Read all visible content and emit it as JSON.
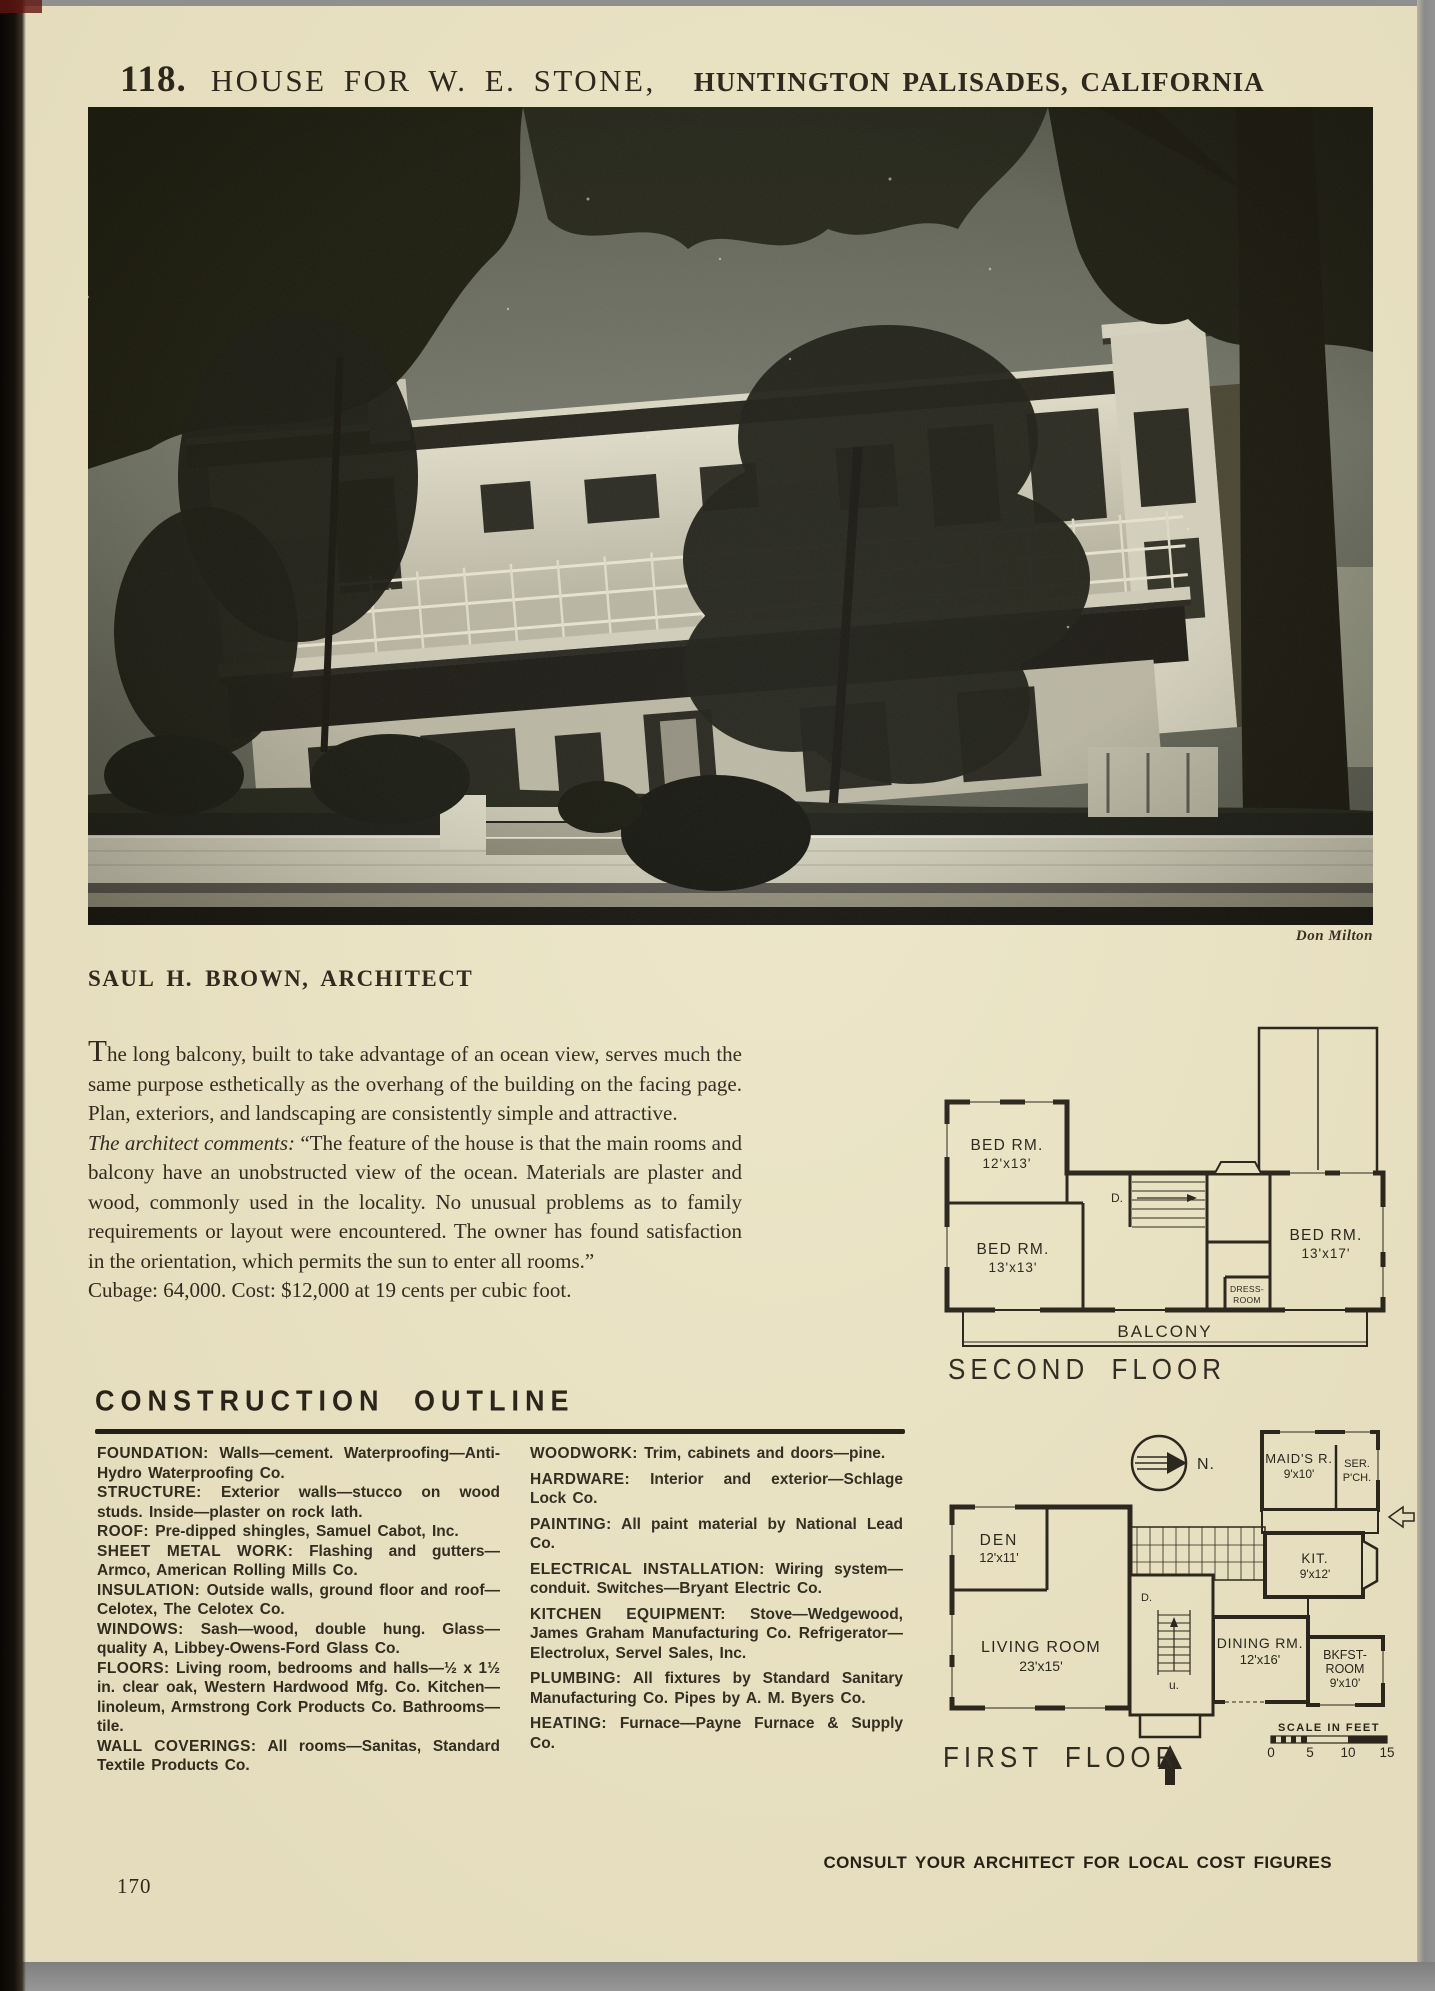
{
  "page": {
    "plate_number": "118.",
    "title": "HOUSE FOR W. E. STONE,",
    "location": "HUNTINGTON PALISADES, CALIFORNIA",
    "photo_credit": "Don Milton",
    "architect": "SAUL H. BROWN, ARCHITECT",
    "footer": "CONSULT YOUR ARCHITECT FOR LOCAL COST FIGURES",
    "page_number": "170"
  },
  "intro": {
    "p1": "The long balcony, built to take advantage of an ocean view, serves much the same purpose esthetically as the overhang of the building on the facing page. Plan, exteriors, and landscaping are consistently simple and attractive.",
    "p2_lead": "The architect comments:",
    "p2": "“The feature of the house is that the main rooms and balcony have an unobstructed view of the ocean. Materials are plaster and wood, commonly used in the locality. No unusual problems as to family requirements or layout were encountered. The owner has found satisfaction in the orientation, which permits the sun to enter all rooms.”",
    "p3": "Cubage: 64,000. Cost: $12,000 at 19 cents per cubic foot."
  },
  "construction_outline": {
    "heading": "CONSTRUCTION OUTLINE",
    "left_column": [
      {
        "label": "FOUNDATION:",
        "text": "Walls—cement. Waterproofing—Anti-Hydro Waterproofing Co."
      },
      {
        "label": "STRUCTURE:",
        "text": "Exterior walls—stucco on wood studs. Inside—plaster on rock lath."
      },
      {
        "label": "ROOF:",
        "text": "Pre-dipped shingles, Samuel Cabot, Inc."
      },
      {
        "label": "SHEET METAL WORK:",
        "text": "Flashing and gutters—Armco, American Rolling Mills Co."
      },
      {
        "label": "INSULATION:",
        "text": "Outside walls, ground floor and roof—Celotex, The Celotex Co."
      },
      {
        "label": "WINDOWS:",
        "text": "Sash—wood, double hung. Glass—quality A, Libbey-Owens-Ford Glass Co."
      },
      {
        "label": "FLOORS:",
        "text": "Living room, bedrooms and halls—½ x 1½ in. clear oak, Western Hardwood Mfg. Co. Kitchen—linoleum, Armstrong Cork Products Co. Bathrooms—tile."
      },
      {
        "label": "WALL COVERINGS:",
        "text": "All rooms—Sanitas, Standard Textile Products Co."
      }
    ],
    "right_column": [
      {
        "label": "WOODWORK:",
        "text": "Trim, cabinets and doors—pine."
      },
      {
        "label": "HARDWARE:",
        "text": "Interior and exterior—Schlage Lock Co."
      },
      {
        "label": "PAINTING:",
        "text": "All paint material by National Lead Co."
      },
      {
        "label": "ELECTRICAL INSTALLATION:",
        "text": "Wiring system—conduit. Switches—Bryant Electric Co."
      },
      {
        "label": "KITCHEN EQUIPMENT:",
        "text": "Stove—Wedgewood, James Graham Manufacturing Co. Refrigerator—Electrolux, Servel Sales, Inc."
      },
      {
        "label": "PLUMBING:",
        "text": "All fixtures by Standard Sanitary Manufacturing Co. Pipes by A. M. Byers Co."
      },
      {
        "label": "HEATING:",
        "text": "Furnace—Payne Furnace & Supply Co."
      }
    ]
  },
  "plans": {
    "second_floor": {
      "caption": "SECOND FLOOR",
      "bedroom1": {
        "name": "BED RM.",
        "size": "12'x13'"
      },
      "bedroom2": {
        "name": "BED RM.",
        "size": "13'x13'"
      },
      "bedroom3": {
        "name": "BED RM.",
        "size": "13'x17'"
      },
      "dress_room": {
        "line1": "DRESS-",
        "line2": "ROOM"
      },
      "balcony": "BALCONY",
      "stair_down": "D."
    },
    "first_floor": {
      "caption": "FIRST FLOOR",
      "north": "N.",
      "den": {
        "name": "DEN",
        "size": "12'x11'"
      },
      "living": {
        "name": "LIVING ROOM",
        "size": "23'x15'"
      },
      "dining": {
        "name": "DINING RM.",
        "size": "12'x16'"
      },
      "kitchen": {
        "name": "KIT.",
        "size": "9'x12'"
      },
      "breakfast": {
        "line1": "BKFST-",
        "line2": "ROOM",
        "size": "9'x10'"
      },
      "maids": {
        "name": "MAID'S R.",
        "size": "9'x10'"
      },
      "service_porch": {
        "line1": "SER.",
        "line2": "P'CH."
      },
      "stair_down": "D.",
      "stair_up": "u.",
      "scale_label": "SCALE IN FEET",
      "scale_ticks": [
        "0",
        "5",
        "10",
        "15"
      ]
    }
  }
}
